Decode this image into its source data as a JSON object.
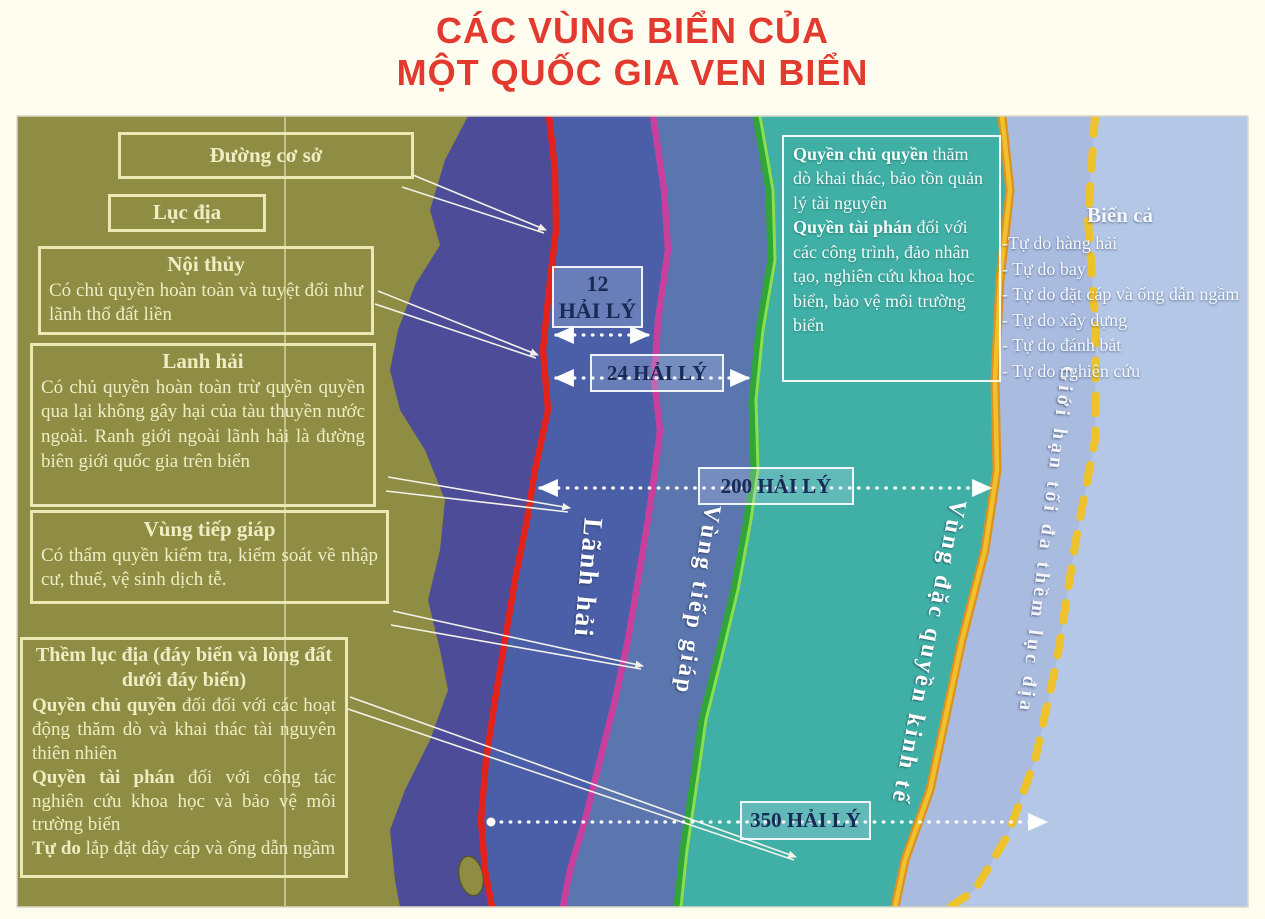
{
  "title": {
    "line1": "CÁC VÙNG BIỂN CỦA",
    "line2": "MỘT QUỐC GIA VEN BIỂN"
  },
  "left_boxes": {
    "baseline": {
      "heading": "Đường cơ sở"
    },
    "continent": {
      "heading": "Lục địa"
    },
    "internal_waters": {
      "heading": "Nội thủy",
      "body": "Có chủ quyền hoàn toàn và tuyệt đối như lãnh thổ đất liền"
    },
    "territorial_sea": {
      "heading": "Lanh hải",
      "body": "Có chủ quyền hoàn toàn trừ quyền quyền qua lại không gây hại của tàu thuyền nước ngoài. Ranh giới ngoài lãnh hải là đường biên giới quốc gia trên biển"
    },
    "contiguous_zone": {
      "heading": "Vùng tiếp giáp",
      "body": "Có thẩm quyền kiểm tra, kiểm soát về nhập cư, thuế, vệ sinh dịch tễ."
    },
    "continental_shelf": {
      "heading": "Thềm lục địa (đáy biển và lòng đất dưới đáy biển)",
      "segments": [
        {
          "bold": "Quyền chủ quyền",
          "text": " đối đối với các hoạt động thăm dò và khai thác tài nguyên thiên nhiên"
        },
        {
          "bold": "Quyền tài phán",
          "text": " đối với công tác nghiên cứu khoa học và bảo vệ môi trường biển"
        },
        {
          "bold": "Tự do",
          "text": " lắp đặt dây cáp và ống dẫn ngầm"
        }
      ]
    }
  },
  "measurements": {
    "nm12": {
      "value": "12",
      "unit": "HẢI LÝ"
    },
    "nm24": {
      "label": "24 HẢI LÝ"
    },
    "nm200": {
      "label": "200 HẢI LÝ"
    },
    "nm350": {
      "label": "350 HẢI LÝ"
    }
  },
  "zone_labels": {
    "territorial_sea": "Lãnh hải",
    "contiguous_zone": "Vùng tiếp giáp",
    "eez": "Vùng đặc quyền kinh tế",
    "shelf_limit": "Giới hạn tối đa thềm lục địa"
  },
  "eez_box": {
    "segments": [
      {
        "bold": "Quyền chủ quyền",
        "text": " thăm dò khai thác, bảo tồn quản lý tài nguyên"
      },
      {
        "bold": "Quyền tài phán",
        "text": " đối với các công trình, đảo nhân tạo, nghiên cứu khoa học biển, bảo vệ môi trường biển"
      }
    ]
  },
  "high_seas": {
    "heading": "Biển cả",
    "items": [
      "-Tự do hàng hải",
      "- Tự do bay",
      "- Tự do đặt  cáp và ống dẫn ngầm",
      "- Tự do xây dựng",
      "- Tự do đánh bắt",
      "- Tự do nghiên cứu"
    ]
  },
  "colors": {
    "title_red": "#e23a2e",
    "land_olive": "#8e8d43",
    "internal_waters": "#4d4c98",
    "territorial_sea": "#4a5fa7",
    "contiguous_zone": "#5b76af",
    "eez_teal": "#40b0a6",
    "shelf_band": "#a9bbdf",
    "high_seas": "#b5c7e6",
    "baseline_line": "#e2231c",
    "territorial_limit_line": "#c93f9d",
    "contiguous_limit_line": "#3bb33a",
    "eez_limit_line": "#eab62a",
    "shelf_limit_dashed": "#eec22b",
    "label_box_border": "#ebe8b4",
    "measurement_text": "#182a56"
  }
}
